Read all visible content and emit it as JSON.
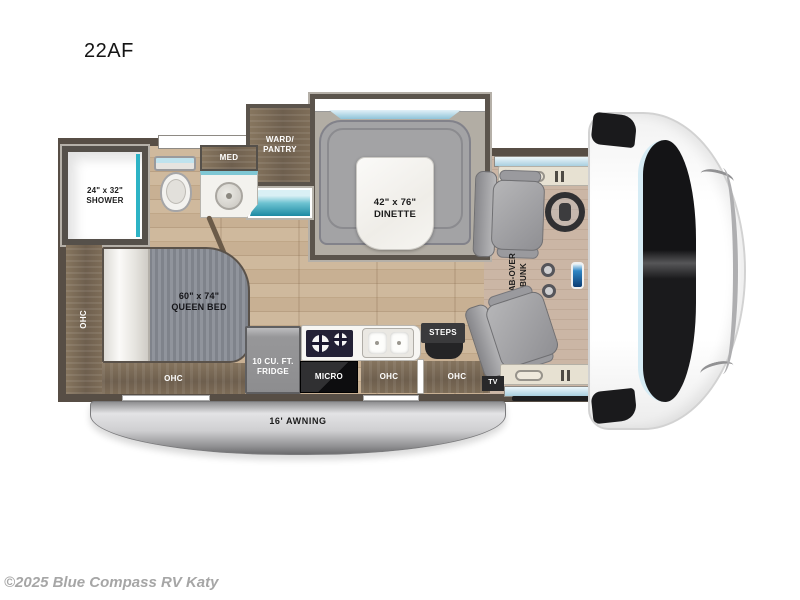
{
  "page": {
    "title": "22AF",
    "copyright": "©2025 Blue Compass RV Katy"
  },
  "floorplan": {
    "ward_pantry": {
      "line1": "WARD/",
      "line2": "PANTRY"
    },
    "med": "MED",
    "dinette": {
      "size": "42\" x 76\"",
      "name": "DINETTE"
    },
    "shower": {
      "size": "24\" x 32\"",
      "name": "SHOWER"
    },
    "queen_bed": {
      "size": "60\" x 74\"",
      "name": "QUEEN BED"
    },
    "ohc_bed_side": "OHC",
    "ohc_bed_foot": "OHC",
    "fridge": {
      "line1": "10 CU. FT.",
      "line2": "FRIDGE"
    },
    "micro": "MICRO",
    "ohc_kitchen": "OHC",
    "ohc_entry": "OHC",
    "steps": "STEPS",
    "cab_over_bunk": {
      "line1": "CAB-OVER",
      "line2": "BUNK"
    },
    "tv": "TV",
    "awning": "16' AWNING"
  },
  "colors": {
    "wall": "#574e45",
    "wood_floor": "#c8b093",
    "cabinet_wood": "#7a6a56",
    "accent_teal": "#2db3c5",
    "bench_gray": "#a3a3a5",
    "window_blue": "#a9cfdf",
    "awning_gray": "#cfcfd1"
  }
}
